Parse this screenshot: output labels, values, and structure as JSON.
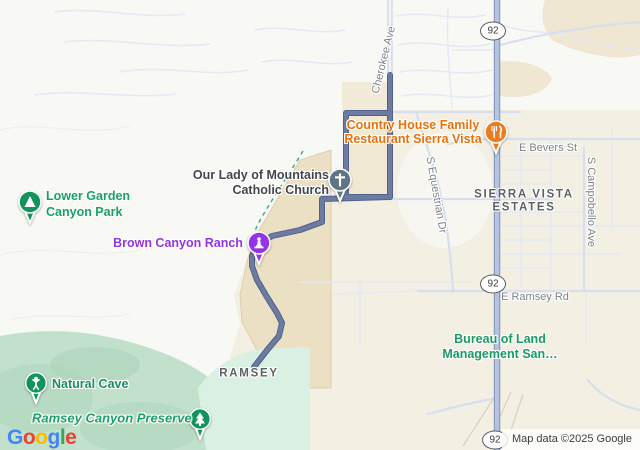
{
  "map": {
    "attribution": "Map data ©2025 Google",
    "logo_letters": [
      {
        "ch": "G",
        "color": "#4285F4"
      },
      {
        "ch": "o",
        "color": "#EA4335"
      },
      {
        "ch": "o",
        "color": "#FBBC05"
      },
      {
        "ch": "g",
        "color": "#4285F4"
      },
      {
        "ch": "l",
        "color": "#34A853"
      },
      {
        "ch": "e",
        "color": "#EA4335"
      }
    ],
    "route_color": "#6d7ba1",
    "highway_color": "#b4c3e1",
    "terrain_city_color": "#f3efe2",
    "terrain_green_color": "#c2e1cc"
  },
  "shields": [
    "92",
    "92",
    "92"
  ],
  "labels": {
    "cherokee": {
      "text": "Cherokee Ave"
    },
    "restaurant": {
      "line1": "Country House Family",
      "line2": "Restaurant Sierra Vista",
      "color": "#e8710a"
    },
    "e_bevers": {
      "text": "E Bevers St"
    },
    "church": {
      "line1": "Our Lady of Mountains",
      "line2": "Catholic Church",
      "color": "#43474c"
    },
    "sierra_vista_estates": {
      "line1": "SIERRA VISTA",
      "line2": "ESTATES"
    },
    "s_equestrian": {
      "text": "S Equestrian Dr"
    },
    "s_campobello": {
      "text": "S Campobello Ave"
    },
    "lower_garden": {
      "line1": "Lower Garden",
      "line2": "Canyon Park",
      "color": "#1aa064"
    },
    "brown_canyon": {
      "text": "Brown Canyon Ranch",
      "color": "#9334e6"
    },
    "e_ramsey": {
      "text": "E Ramsey Rd"
    },
    "bureau": {
      "line1": "Bureau of Land",
      "line2": "Management San…",
      "color": "#1a9b64"
    },
    "natural_cave": {
      "text": "Natural Cave",
      "color": "#17905c"
    },
    "ramsey": {
      "text": "RAMSEY"
    },
    "ramsey_preserve": {
      "text": "Ramsey Canyon Preserve",
      "color": "#1aa064"
    }
  }
}
